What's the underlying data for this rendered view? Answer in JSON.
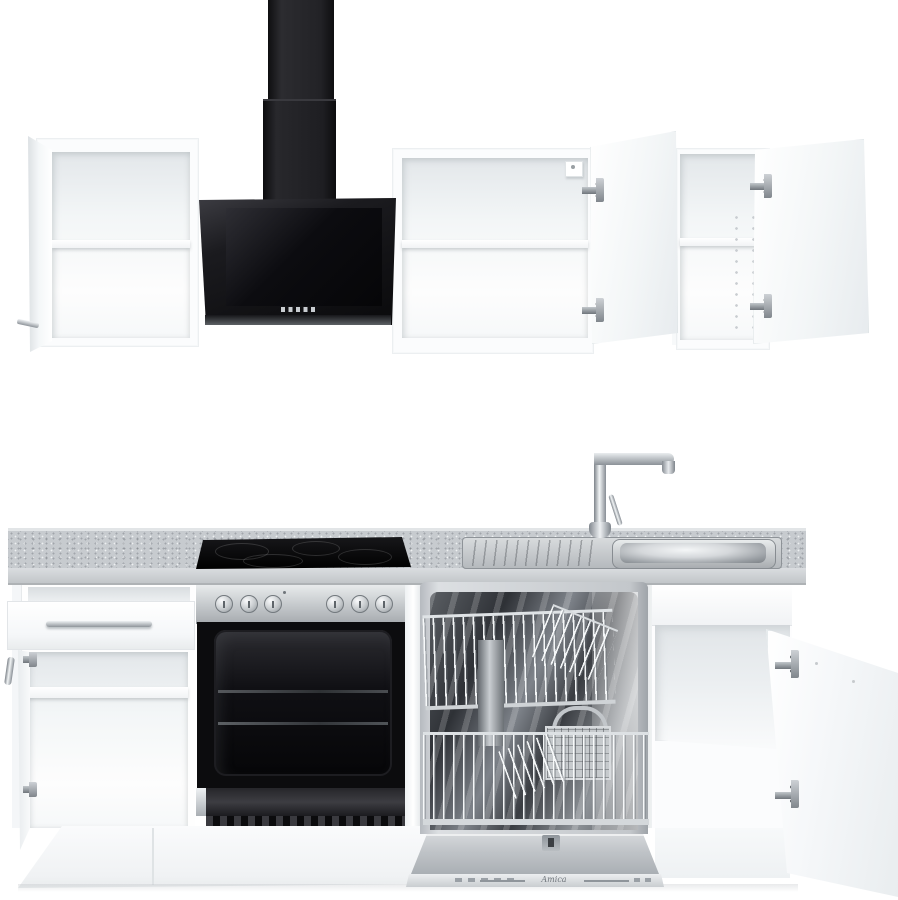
{
  "scene": {
    "type": "product-photo",
    "subject": "White fitted kitchen unit, front view, with all doors and drawers open",
    "background": "#ffffff"
  },
  "colors": {
    "bg": "#ffffff",
    "cabinet_face": "#fbfcfd",
    "cabinet_edge": "#e2e6e8",
    "interior_shade": "#e7ebed",
    "hood_black": "#131316",
    "hood_glass": "#060608",
    "counter_top": "#c7cbcf",
    "counter_face": "#d5d8db",
    "stainless_light": "#e6e9eb",
    "stainless_dark": "#8f959a",
    "chrome_dark": "#7d838a",
    "oven_cavity": "#0c0c0e",
    "hinge_metal": "#9aa0a6",
    "plinth": "#f3f5f6"
  },
  "appliances": {
    "hood": {
      "name": "black angled extractor hood with chimney duct",
      "button_count": 5
    },
    "cooktop": {
      "name": "black ceramic glass hob",
      "zone_count": 4
    },
    "oven": {
      "name": "stainless built-in oven, door open",
      "knob_count": 6
    },
    "dishwasher": {
      "name": "integrated dishwasher, open with baskets",
      "brand": "Amica"
    },
    "sink": {
      "name": "stainless steel sink with left drainer"
    },
    "faucet": {
      "name": "chrome high-arc mixer tap"
    }
  },
  "furniture": {
    "wall_cabinets": [
      "left wall cabinet, door open left, one shelf",
      "middle wall cabinet, door open right, one shelf",
      "right wall cabinet, door open right, one shelf"
    ],
    "base_cabinets": [
      "left base cabinet with open drawer and open door, one shelf",
      "sink base cabinet, door open right, empty"
    ]
  }
}
